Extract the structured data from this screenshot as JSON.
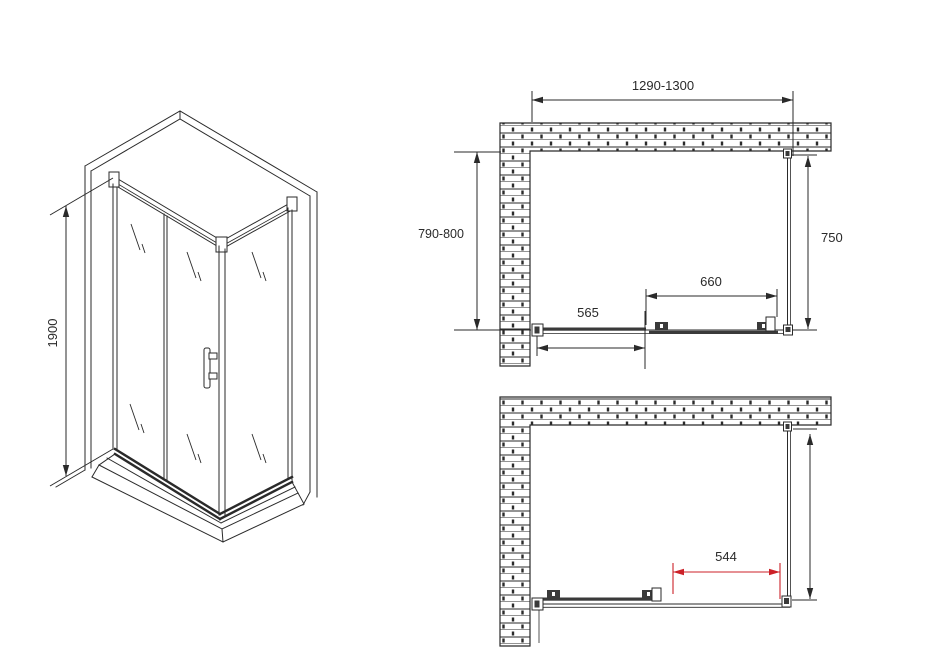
{
  "drawing": {
    "background": "#ffffff",
    "line_color": "#2a2a2a",
    "accent_red": "#cc2128"
  },
  "iso_view": {
    "height_label": "1900"
  },
  "plan_top": {
    "width_label": "1290-1300",
    "depth_label": "790-800",
    "side_panel_label": "750",
    "door_label": "660",
    "fixed_panel_label": "565"
  },
  "plan_bottom": {
    "opening_label": "544"
  }
}
